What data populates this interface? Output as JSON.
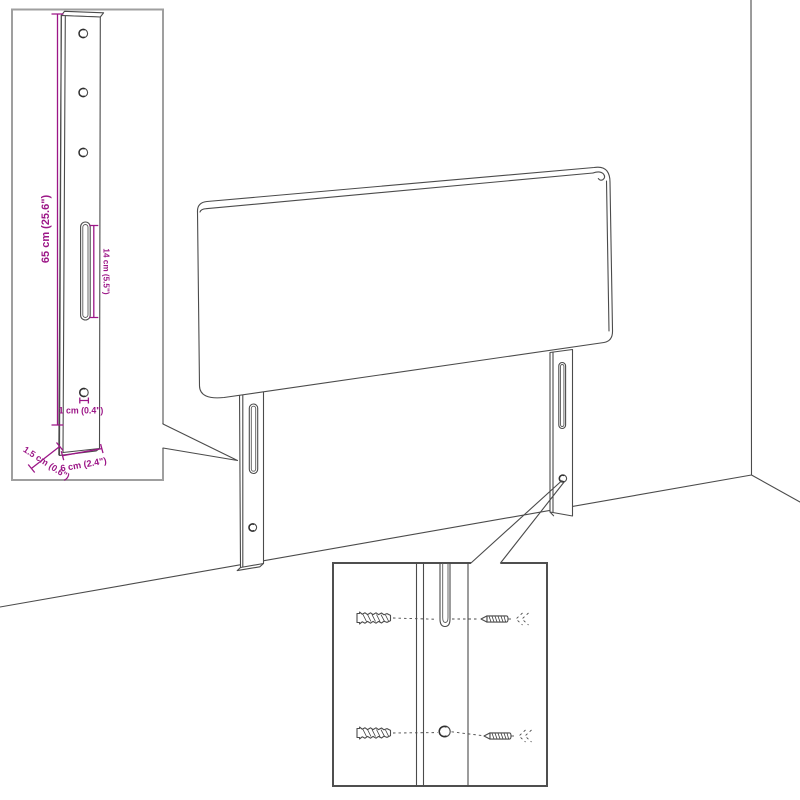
{
  "diagram": {
    "description": "Line drawing of a headboard with two mounting legs standing against a wall corner, with a leg dimension inset and a wall-mounting hardware inset",
    "colors": {
      "dimension": "#9c1687",
      "line": "#4b4b4b",
      "inset_border": "#9f9f9f",
      "background": "#ffffff"
    },
    "leg_dimension_inset": {
      "labels": {
        "leg_height": "65 cm (25.6\")",
        "slot_length": "14 cm (5.5\")",
        "hole_diameter": "1 cm (0.4\")",
        "leg_thickness": "1.5 cm (0.6\")",
        "leg_width": "6 cm (2.4\")"
      }
    },
    "mounting_hardware_inset": {
      "hardware": [
        {
          "icon": "wall-plug-icon",
          "target": "mounting-slot"
        },
        {
          "icon": "screw-icon",
          "target": "mounting-slot"
        },
        {
          "icon": "wall-plug-icon",
          "target": "mounting-hole"
        },
        {
          "icon": "screw-icon",
          "target": "mounting-hole"
        }
      ]
    }
  }
}
